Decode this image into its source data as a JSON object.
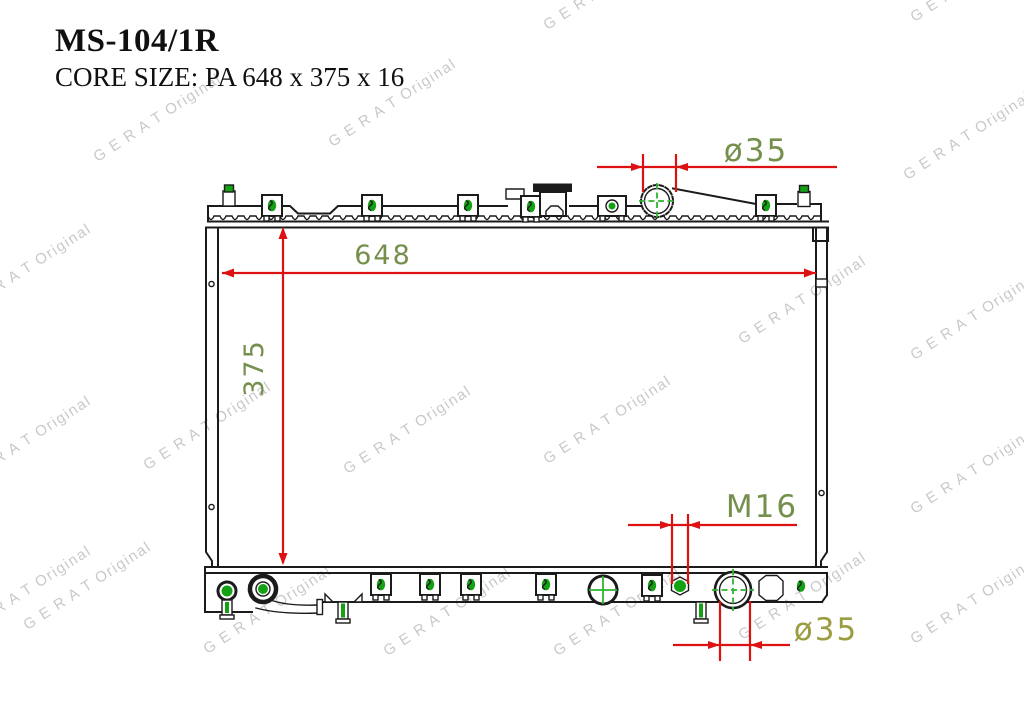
{
  "header": {
    "part_number": "MS-104/1R",
    "core_size": "CORE SIZE: PA 648 x 375 x 16"
  },
  "watermark": {
    "text": "G E R A T Original",
    "color": "#c9c9c9"
  },
  "diagram": {
    "type": "radiator technical drawing",
    "labels": {
      "core_width": "648",
      "core_height": "375",
      "top_neck_diameter": "ø35",
      "drain_thread": "M16",
      "bottom_neck_diameter": "ø35"
    },
    "colors": {
      "outline": "#1b1b1b",
      "dimension_line": "#dd1111",
      "dimension_text": "#74904c",
      "dimension_text_bottom": "#9b9d41",
      "fitting_green": "#14a214",
      "crosshair_green": "#2eb42e"
    }
  }
}
